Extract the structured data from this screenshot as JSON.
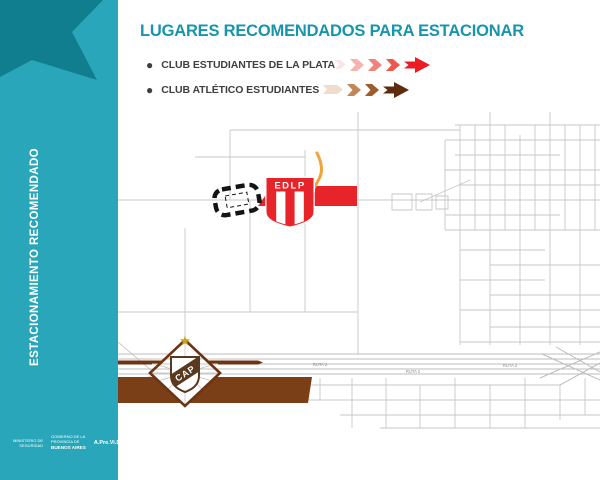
{
  "poster": {
    "title": "LUGARES RECOMENDADOS PARA ESTACIONAR",
    "title_color": "#1795AC"
  },
  "legend": {
    "items": [
      {
        "label": "CLUB ESTUDIANTES DE LA PLATA",
        "arrow_colors": [
          "#FAE6E4",
          "#F6B3AE",
          "#F0837C",
          "#EE564E",
          "#EC1C24"
        ]
      },
      {
        "label": "CLUB ATLÉTICO ESTUDIANTES",
        "arrow_colors": [
          "#F0DBCC",
          "#C28757",
          "#9C5C2B",
          "#5D2B0D"
        ]
      }
    ]
  },
  "sidebar": {
    "vertical_label": "ESTACIONAMIENTO RECOMENDADO",
    "background_color": "#29A6B9",
    "star_color": "#117E8F",
    "footer": {
      "ministry_line1": "MINISTERIO DE",
      "ministry_line2": "SEGURIDAD",
      "government_line1": "GOBIERNO DE LA",
      "government_line2": "PROVINCIA DE",
      "government_line3": "BUENOS AIRES",
      "agency": "A.Pre.Vi.De."
    }
  },
  "map": {
    "edlp_badge_text": "EDLP",
    "cap_badge_text": "CAP",
    "road_label_1": "RUTA 2",
    "road_label_2": "RUTA 2",
    "road_label_3": "RUTA 2",
    "estudiantes_zone_color": "#E8242B",
    "atletico_zone_color": "#7B3F17",
    "route_highlight_color": "#F2A33C"
  }
}
